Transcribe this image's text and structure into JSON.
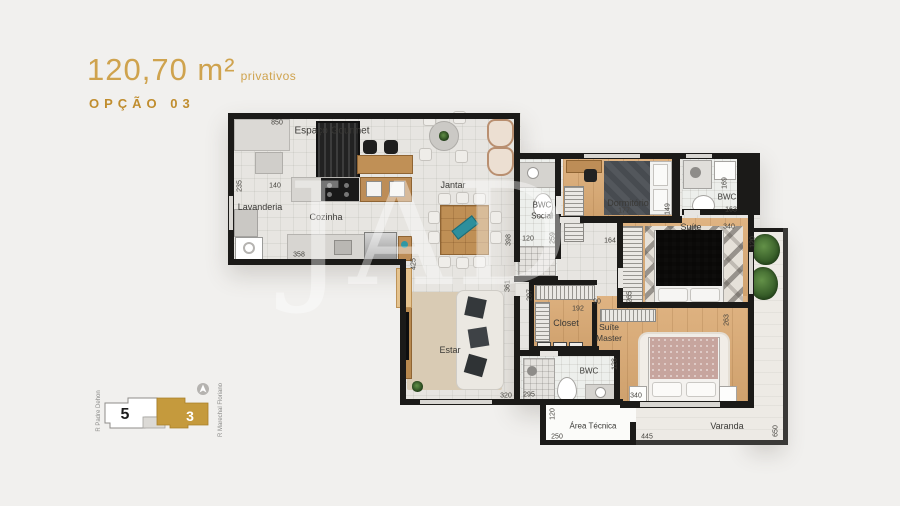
{
  "header": {
    "area": "120,70 m²",
    "area_suffix": "privativos",
    "option": "OPÇÃO 03"
  },
  "watermark": {
    "text": "JAD"
  },
  "rooms": {
    "espaco_gourmet": "Espaço Gourmet",
    "lavanderia": "Lavanderia",
    "cozinha": "Cozinha",
    "jantar": "Jantar",
    "bwc_social_1": "BWC",
    "bwc_social_2": "Social",
    "dormitorio": "Dormitório",
    "bwc_suite": "BWC",
    "suite": "Suíte",
    "estar": "Estar",
    "closet": "Closet",
    "suite_master_1": "Suíte",
    "suite_master_2": "Master",
    "bwc_master": "BWC",
    "area_tecnica": "Área Técnica",
    "varanda": "Varanda"
  },
  "dims": {
    "gourmet_w": "850",
    "lavanderia_h": "235",
    "lavanderia_w": "140",
    "cozinha_w": "358",
    "cozinha_h": "425",
    "jantar_h": "398",
    "estar_h": "361",
    "estar_w": "320",
    "bwc_social_w": "120",
    "bwc_social_h": "259",
    "dormitorio_w": "177",
    "hall_w": "164",
    "dormitorio_h": "149",
    "bwc_suite_h": "169",
    "bwc_suite_w": "163",
    "suite_w": "340",
    "suite_h": "265",
    "suite_side": "263",
    "varanda_top": "120",
    "closet_h": "207",
    "closet_w": "192",
    "door_w": "90",
    "bwc_master_h": "128",
    "bwc_master_w": "295",
    "master_w": "340",
    "area_tecnica_h": "120",
    "area_tecnica_w": "250",
    "varanda_w": "445",
    "varanda_h": "650"
  },
  "keyplan": {
    "tower_5": "5",
    "tower_3": "3",
    "street_left": "R Padre Dehon",
    "street_right": "R Marechal Floriano"
  },
  "colors": {
    "accent": "#c59a3d"
  }
}
